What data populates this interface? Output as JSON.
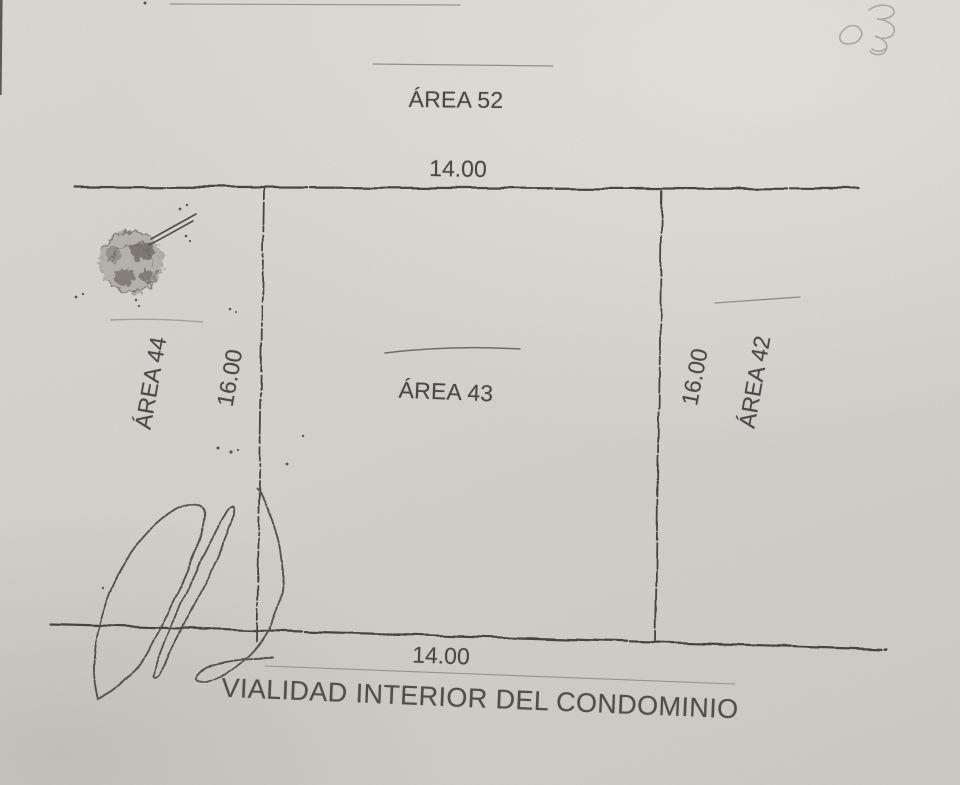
{
  "plan": {
    "areas": {
      "top": "ÁREA 52",
      "center": "ÁREA 43",
      "left": "ÁREA 44",
      "right": "ÁREA 42"
    },
    "dimensions": {
      "top": "14.00",
      "bottom": "14.00",
      "left": "16.00",
      "right": "16.00"
    },
    "road": "VIALIDAD INTERIOR DEL CONDOMINIO",
    "colors": {
      "paper": "#d4d1cc",
      "ink_text": "#4a4846",
      "ink_line": "#3a3833",
      "faint_ink": "#928e87",
      "stamp": "#6e6a64"
    }
  }
}
